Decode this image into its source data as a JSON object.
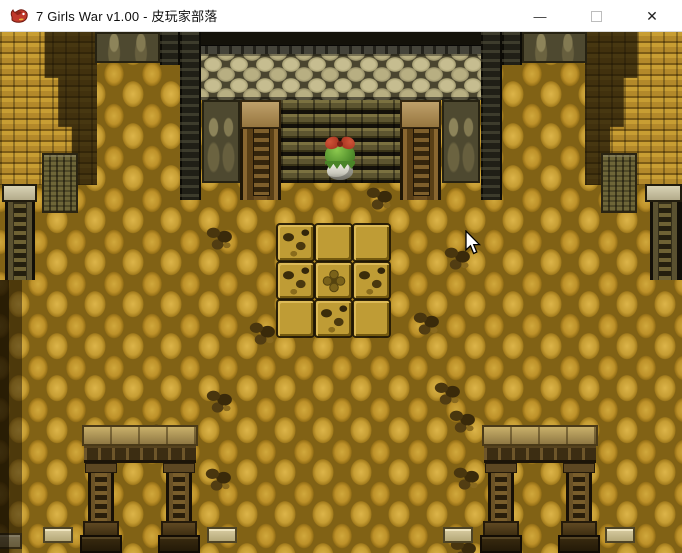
{
  "window": {
    "title": "7 Girls War v1.00 - 皮玩家部落",
    "app_icon": "dragon-icon",
    "controls": {
      "minimize_glyph": "—",
      "maximize_icon": "maximize-box-icon",
      "close_glyph": "✕"
    }
  },
  "colors": {
    "titlebar_bg": "#ffffff",
    "titlebar_text": "#0f0f0f",
    "floor_stone": "#c69d33",
    "floor_gap": "#816215",
    "boulder_wall": "#b8af82",
    "ceiling_dark": "#14120a",
    "wood_frame": "#6e4f20",
    "character_hair": "#55922e",
    "character_bow": "#9c2c1a"
  },
  "cursor": {
    "x": 467,
    "y": 233,
    "icon": "arrow-pointer-icon"
  },
  "scene": {
    "character": "player-girl-green-hair-red-bow",
    "tile_grid": {
      "cols": 3,
      "rows": 3,
      "pattern": [
        "cracked",
        "plain",
        "plain",
        "cracked",
        "emblem",
        "cracked",
        "plain",
        "cracked",
        "plain"
      ]
    },
    "rubble_positions": [
      [
        205,
        193
      ],
      [
        365,
        153
      ],
      [
        443,
        213
      ],
      [
        248,
        288
      ],
      [
        412,
        278
      ],
      [
        205,
        356
      ],
      [
        433,
        348
      ],
      [
        448,
        376
      ],
      [
        452,
        433
      ],
      [
        449,
        505
      ],
      [
        148,
        390
      ],
      [
        204,
        434
      ]
    ],
    "slab_positions": [
      [
        -8,
        501
      ],
      [
        43,
        495
      ],
      [
        207,
        495
      ],
      [
        443,
        495
      ],
      [
        605,
        495
      ]
    ]
  }
}
